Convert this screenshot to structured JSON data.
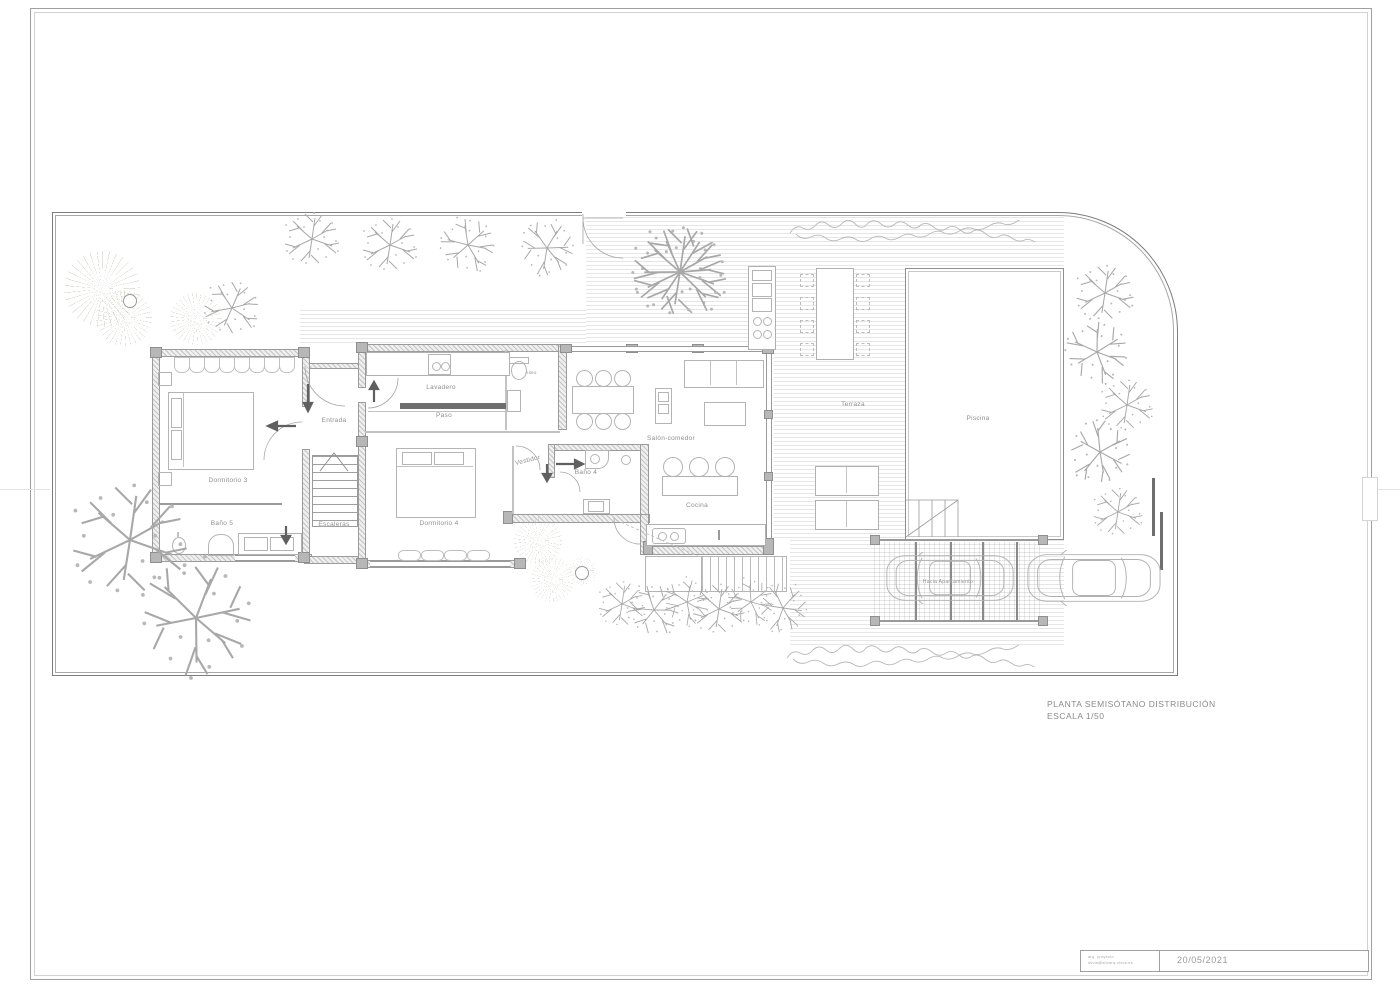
{
  "plan_title": {
    "line1": "PLANTA SEMISÓTANO DISTRIBUCIÓN",
    "line2": "ESCALA 1/50"
  },
  "title_block": {
    "contact_line1": "arq. proyecto",
    "contact_line2": "silvia@silvarq-vives.es",
    "date": "20/05/2021"
  },
  "rooms": {
    "entrada": "Entrada",
    "escaleras": "Escaleras",
    "dormitorio3": "Dormitorio 3",
    "bano5": "Baño 5",
    "lavadero": "Lavadero",
    "paso": "Paso",
    "aseo": "Aseo",
    "dormitorio4": "Dormitorio 4",
    "vestidor": "Vestidor",
    "bano4": "Baño 4",
    "salon_comedor": "Salón-comedor",
    "cocina": "Cocina"
  },
  "outdoor": {
    "terraza": "Terraza",
    "piscina": "Piscina",
    "hacia_aparcamiento": "Hacia Aparcamiento"
  },
  "colors": {
    "linework": "#9a9a9a",
    "wall_edge": "#9b9b9b",
    "pillar": "#b7b7b7",
    "text": "#8f8f8f",
    "deck_stripe": "#e6e6e6",
    "bold_arrow": "#606060"
  }
}
